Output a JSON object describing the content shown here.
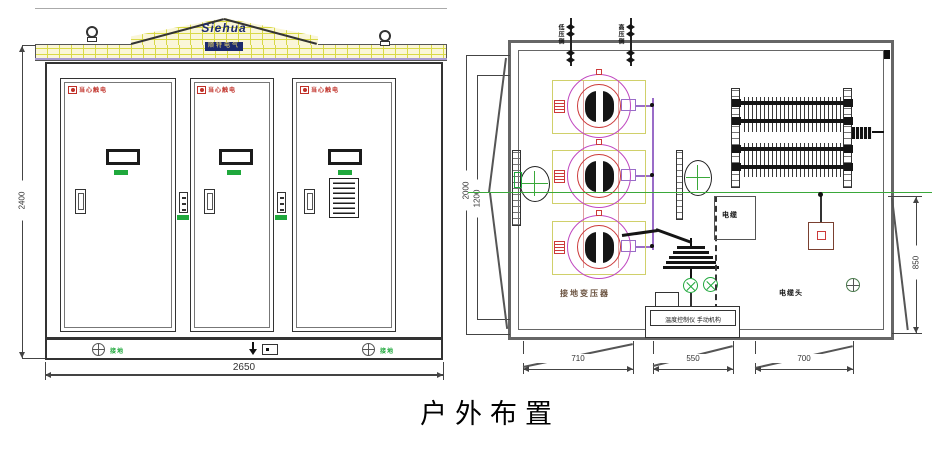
{
  "caption": "户外布置",
  "colors": {
    "brick_fill": "#faf6d8",
    "brick_line": "#d9d946",
    "warning_red": "#c03028",
    "label_green": "#1fa83c",
    "magenta": "#c048c0",
    "red": "#cc3a3a",
    "purple": "#9a6cc8",
    "centerline_green": "#3aa83a",
    "navy": "#1c2a6e"
  },
  "front_view": {
    "logo_text": "Siehua",
    "logo_subtext": "顺特电气",
    "dims": {
      "height": "2400",
      "width": "2650"
    },
    "doors": [
      {
        "warning_label": "当心触电"
      },
      {
        "warning_label": "当心触电"
      },
      {
        "warning_label": "当心触电"
      }
    ],
    "ground_left_label": "接地",
    "ground_right_label": "接地"
  },
  "plan_view": {
    "top_label_lv": "低压侧",
    "top_label_hv": "高压侧",
    "transformer_label": "接地变压器",
    "cable_label": "电缆",
    "cable_head_label": "电缆头",
    "control_label": "温度控制仪 手动机构",
    "dims": {
      "left_outer": "2000",
      "left_inner": "1200",
      "right": "850",
      "bottom": [
        "710",
        "550",
        "700"
      ]
    }
  }
}
